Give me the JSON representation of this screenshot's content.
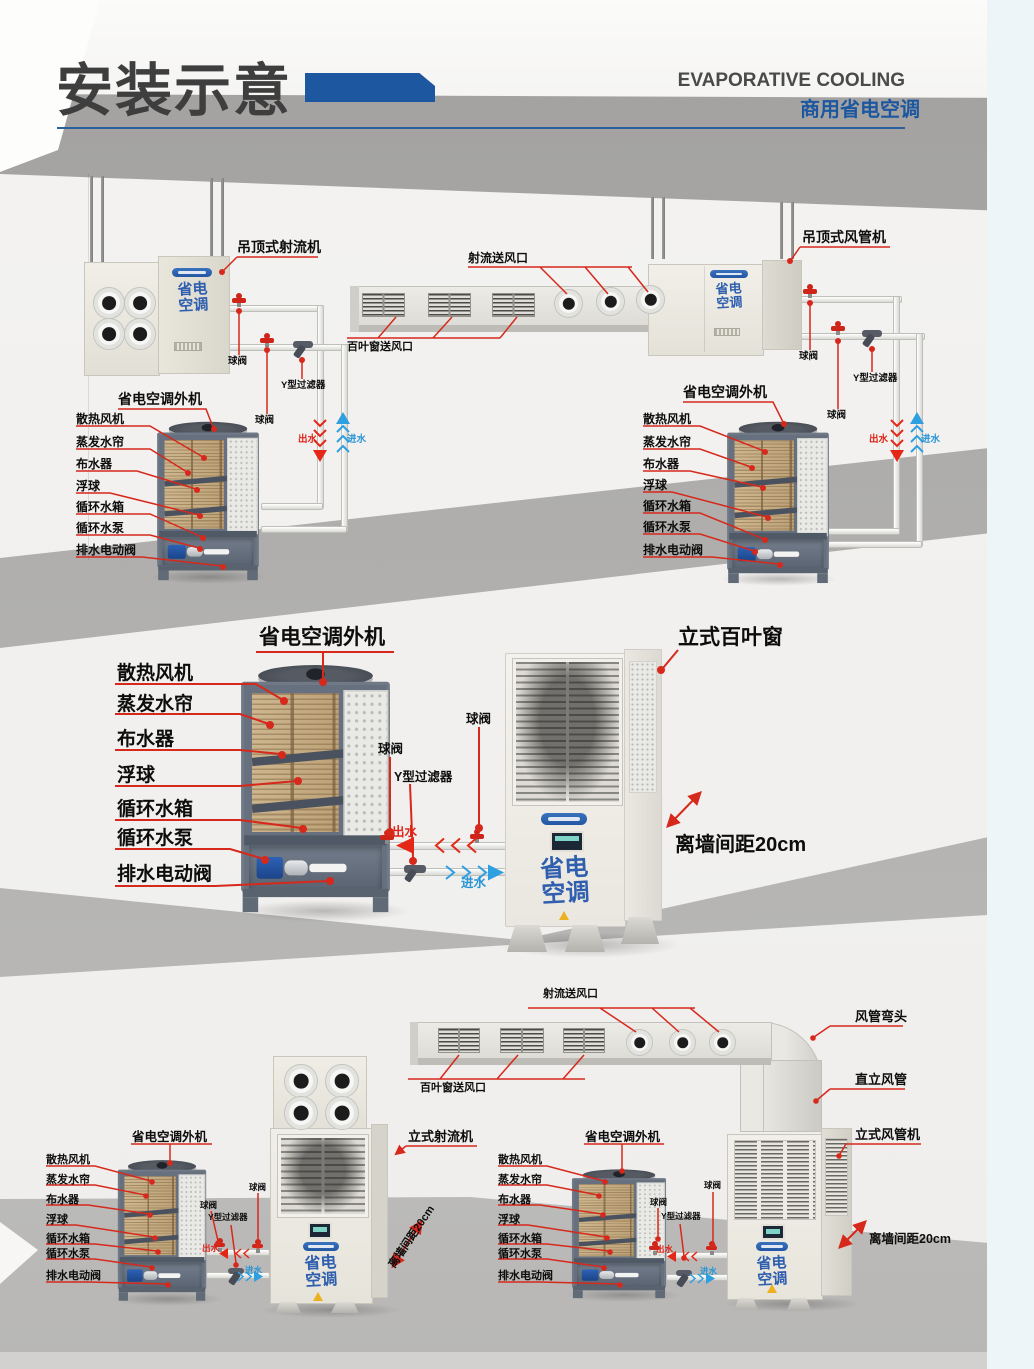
{
  "header": {
    "title": "安装示意",
    "subtitle_en": "EVAPORATIVE COOLING",
    "subtitle_cn": "商用省电空调"
  },
  "labels": {
    "ceiling_jet_unit": "吊顶式射流机",
    "ceiling_duct_unit": "吊顶式风管机",
    "jet_outlet": "射流送风口",
    "louver_outlet": "百叶窗送风口",
    "outdoor_unit": "省电空调外机",
    "ball_valve": "球阀",
    "y_filter": "Y型过滤器",
    "water_out": "出水",
    "water_in": "进水",
    "vertical_louver_unit": "立式百叶窗",
    "wall_distance": "离墙间距20cm",
    "duct_elbow": "风管弯头",
    "vertical_duct": "直立风管",
    "vertical_jet_unit": "立式射流机",
    "vertical_duct_unit": "立式风管机"
  },
  "components": [
    "散热风机",
    "蒸发水帘",
    "布水器",
    "浮球",
    "循环水箱",
    "循环水泵",
    "排水电动阀"
  ],
  "brand": {
    "logo_top": "省电",
    "logo_bottom": "空调"
  },
  "colors": {
    "accent_blue": "#1d57a0",
    "leader_red": "#d7281c",
    "water_out_red": "#e52718",
    "water_in_blue": "#2e9fe0"
  }
}
